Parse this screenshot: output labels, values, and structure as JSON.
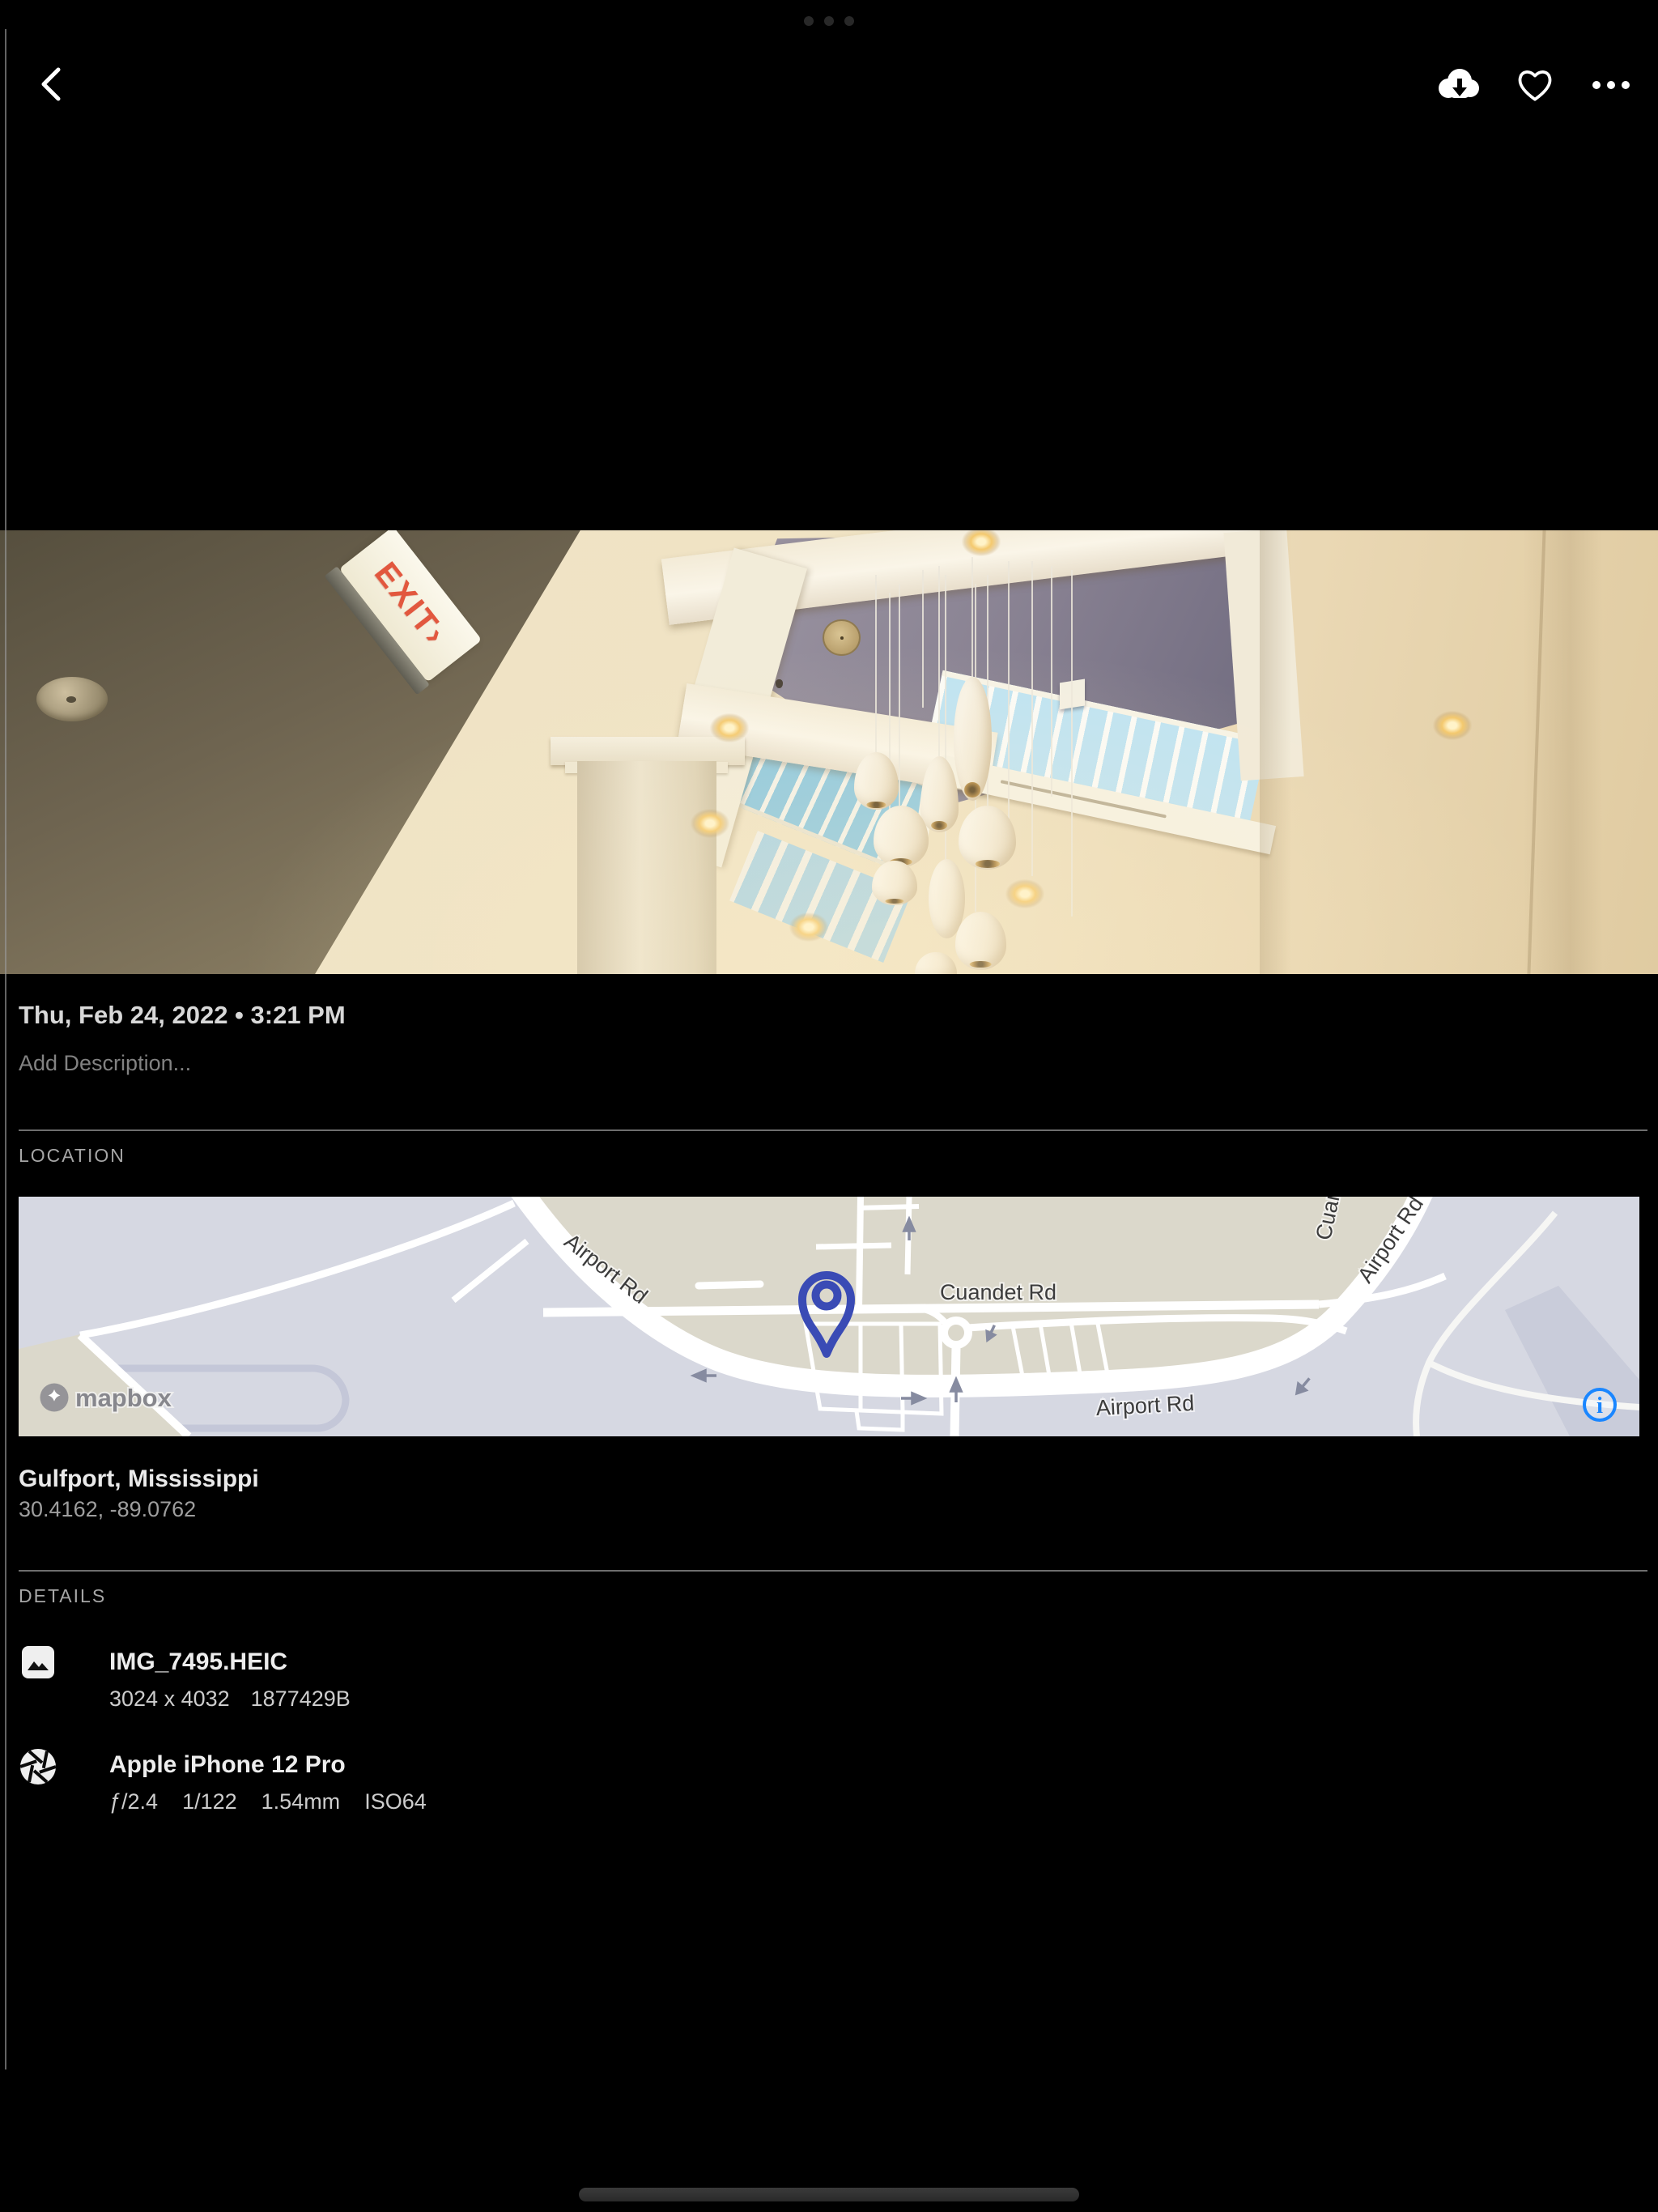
{
  "top_bar": {
    "back_icon": "chevron-left",
    "download_icon": "cloud-download",
    "favorite_icon": "heart-outline",
    "more_icon": "ellipsis-horizontal"
  },
  "photo": {
    "exit_sign": "EXIT›"
  },
  "info": {
    "date": "Thu, Feb 24, 2022 • 3:21 PM",
    "description_placeholder": "Add Description..."
  },
  "location": {
    "label": "LOCATION",
    "place": "Gulfport, Mississippi",
    "coordinates": "30.4162, -89.0762",
    "map": {
      "attribution": "mapbox",
      "info_glyph": "i",
      "pin_color": "#3a4bb5",
      "info_color": "#1a86ff",
      "road_labels": {
        "airport_nw": "Airport Rd",
        "cuandet": "Cuandet Rd",
        "airport_south": "Airport Rd",
        "airport_ne": "Airport Rd",
        "cuandet_top": "Cuandet Rd"
      }
    }
  },
  "details": {
    "label": "DETAILS",
    "file": {
      "name": "IMG_7495.HEIC",
      "dimensions": "3024 x 4032",
      "size_bytes": "1877429B"
    },
    "camera": {
      "model": "Apple iPhone 12 Pro",
      "aperture": "ƒ/2.4",
      "exposure": "1/122",
      "focal_length": "1.54mm",
      "iso": "ISO64"
    }
  }
}
